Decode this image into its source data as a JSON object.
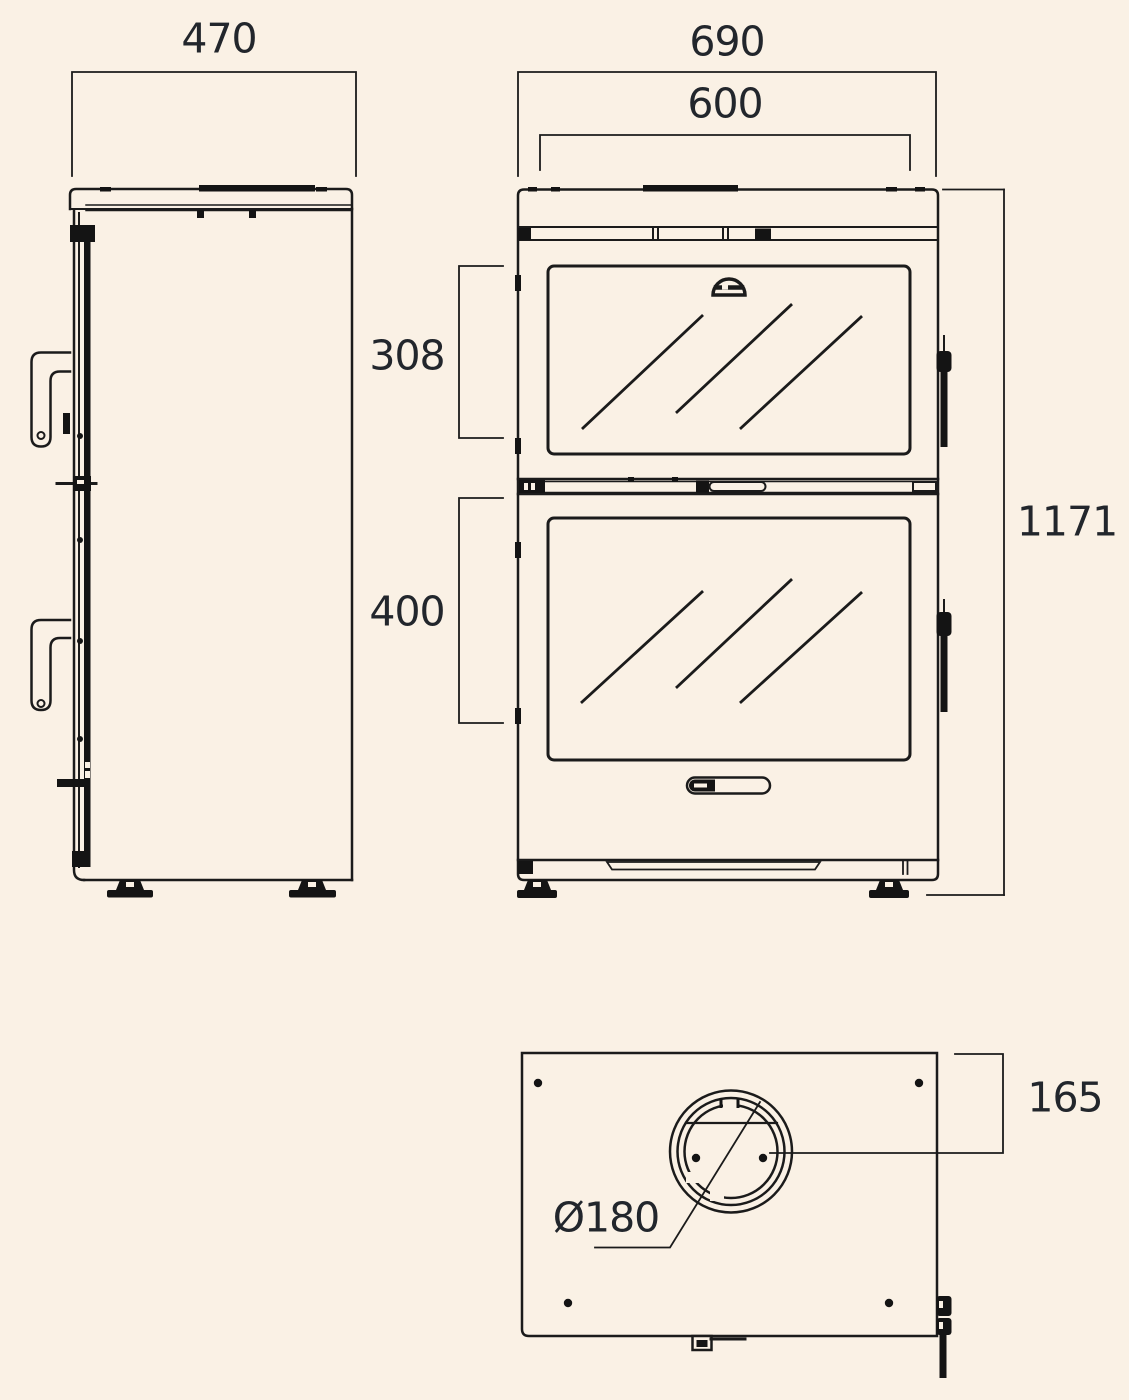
{
  "figure": {
    "type": "technical-dimension-drawing",
    "subject": "two-door stove / oven shown in side, front and top views",
    "background_color": "#faf1e5",
    "line_color": "#1b1b1b",
    "label_color": "#22262c"
  },
  "dimensions": {
    "side_depth": "470",
    "overall_width": "690",
    "glass_width": "600",
    "upper_glass_height": "308",
    "lower_glass_height": "400",
    "overall_height": "1171",
    "flue_center_offset": "165",
    "flue_diameter": "Ø180"
  }
}
